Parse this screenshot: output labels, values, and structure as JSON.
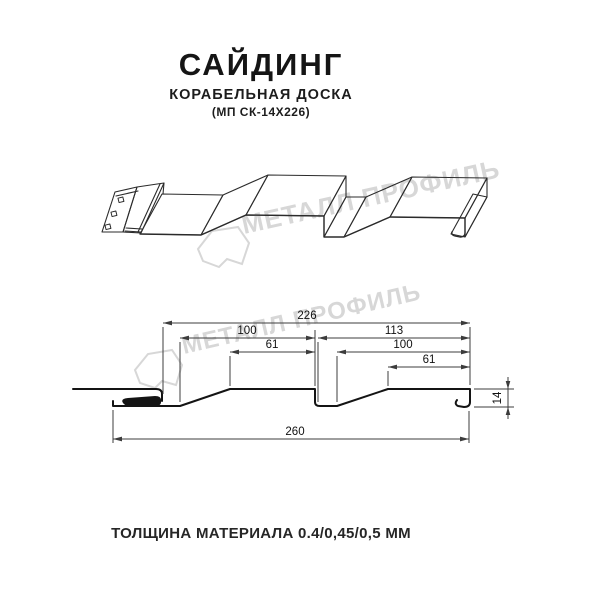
{
  "header": {
    "title": "САЙДИНГ",
    "subtitle": "КОРАБЕЛЬНАЯ ДОСКА",
    "model": "(МП СК-14Х226)"
  },
  "watermark": {
    "brand": "МЕТАЛЛ ПРОФИЛЬ"
  },
  "section": {
    "dims": {
      "overall_top": "226",
      "left_panel": "100",
      "left_flat": "61",
      "right_panel": "113",
      "right_inner": "100",
      "right_flat": "61",
      "overall_bottom": "260",
      "height": "14"
    }
  },
  "footer": {
    "thickness": "ТОЛЩИНА МАТЕРИАЛА 0.4/0,45/0,5 ММ"
  },
  "colors": {
    "ink": "#1c1c1c",
    "dim_line": "#3c3c3c",
    "watermark": "#d7d7d7"
  }
}
